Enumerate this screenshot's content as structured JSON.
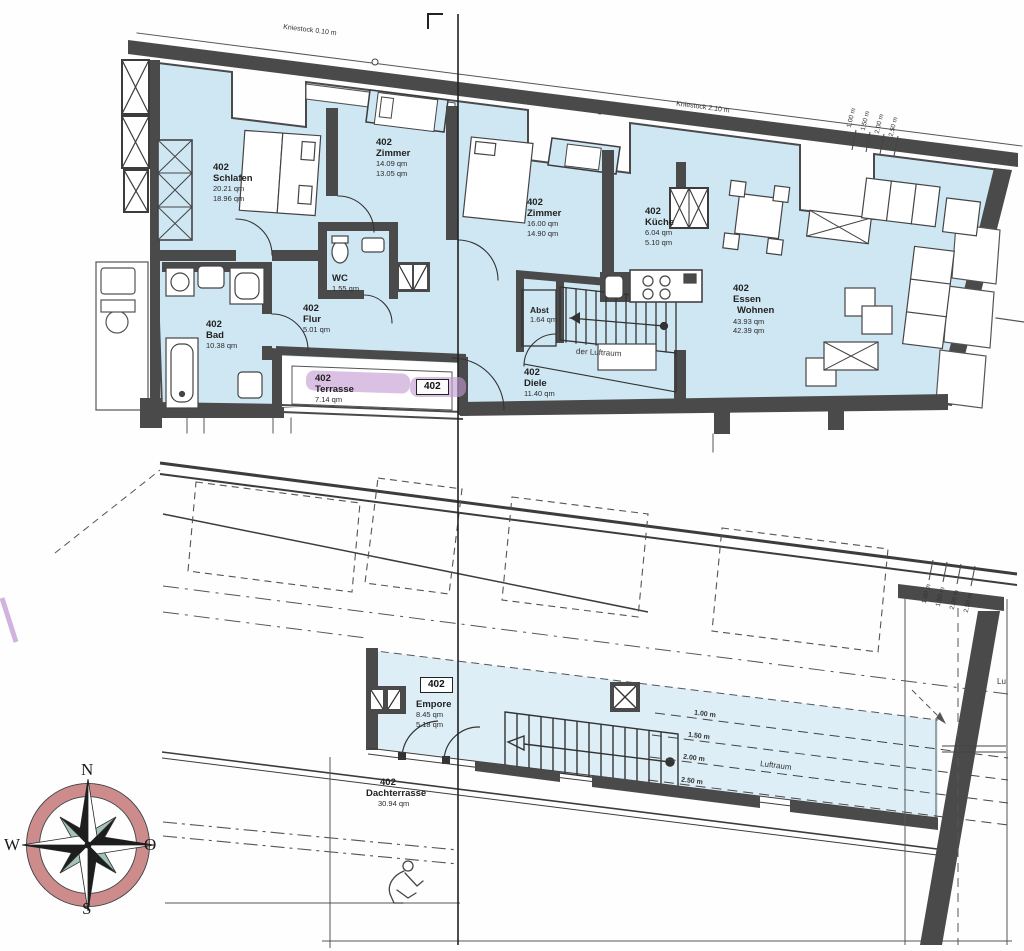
{
  "upper_plan": {
    "kniestock_left": "Kniestock 0.10 m",
    "kniestock_right": "Kniestock 2.10 m",
    "unit_badge": "402",
    "luftraum_note": "der Luftraum",
    "rooms": {
      "schlafen": {
        "id": "402",
        "name": "Schlafen",
        "area_gross": "20.21 qm",
        "area_net": "18.96 qm"
      },
      "zimmer1": {
        "id": "402",
        "name": "Zimmer",
        "area_gross": "14.09 qm",
        "area_net": "13.05 qm"
      },
      "zimmer2": {
        "id": "402",
        "name": "Zimmer",
        "area_gross": "16.00 qm",
        "area_net": "14.90 qm"
      },
      "kueche": {
        "id": "402",
        "name": "Küche",
        "area_gross": "6.04 qm",
        "area_net": "5.10 qm"
      },
      "essen_wohnen": {
        "id": "402",
        "name": "Essen",
        "name2": "Wohnen",
        "area_gross": "43.93 qm",
        "area_net": "42.39 qm"
      },
      "bad": {
        "id": "402",
        "name": "Bad",
        "area_gross": "10.38 qm"
      },
      "wc": {
        "name": "WC",
        "area_gross": "1.55 qm"
      },
      "flur": {
        "id": "402",
        "name": "Flur",
        "area_gross": "5.01 qm"
      },
      "terrasse": {
        "id": "402",
        "name": "Terrasse",
        "area_gross": "7.14 qm"
      },
      "diele": {
        "id": "402",
        "name": "Diele",
        "area_gross": "11.40 qm"
      },
      "abst": {
        "name": "Abst",
        "area_gross": "1.64 qm"
      }
    }
  },
  "lower_plan": {
    "unit_badge": "402",
    "luftraum_note": "Luftraum",
    "luftraum_partial": "Lu",
    "rooms": {
      "empore": {
        "name": "Empore",
        "area_gross": "8.45 qm",
        "area_net": "5.18 qm"
      },
      "dachterrasse": {
        "id": "402",
        "name": "Dachterrasse",
        "area_gross": "30.94 qm"
      }
    }
  },
  "annotations": {
    "heights": [
      "1.00 m",
      "1.50 m",
      "2.00 m",
      "2.50 m"
    ]
  },
  "compass": {
    "north": "N",
    "south": "S",
    "west": "W",
    "east": "O"
  },
  "colors": {
    "room_fill": "#cfe7f3",
    "room_fill_lower": "#ddeef7",
    "wall": "#4a4a4a",
    "highlight": "#c49bd4",
    "compass_ring": "#cd8b8b",
    "compass_teal": "#a3c3bb"
  }
}
